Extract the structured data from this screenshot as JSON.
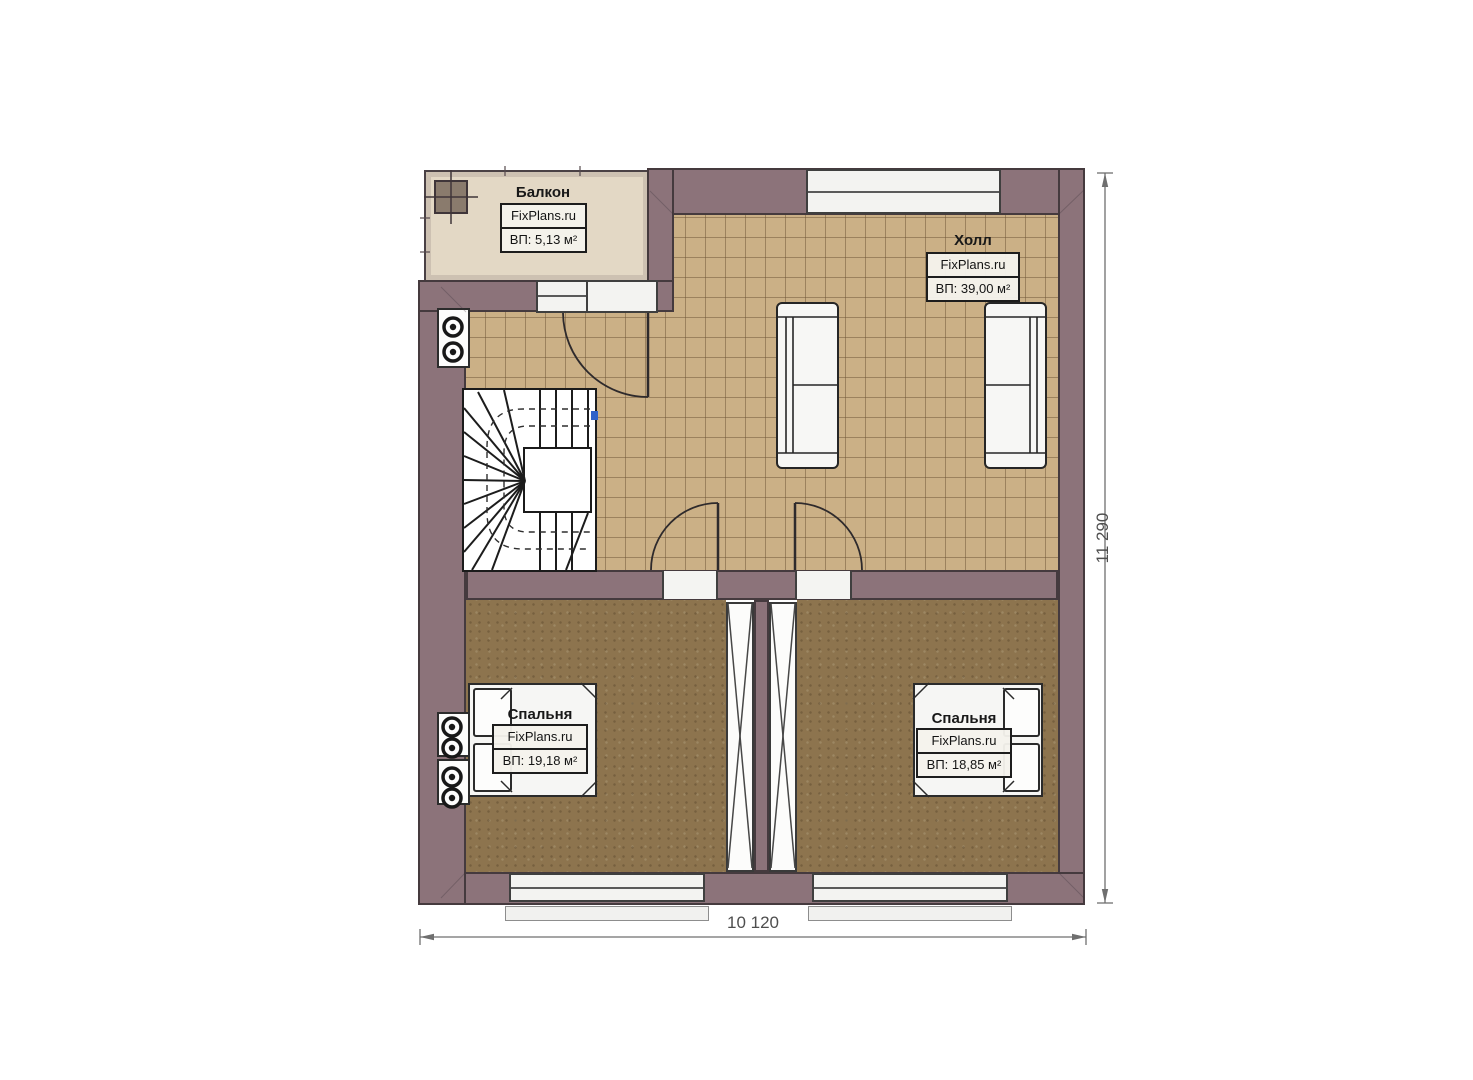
{
  "plan": {
    "rooms": {
      "balcony": {
        "name": "Балкон",
        "source": "FixPlans.ru",
        "area": "ВП: 5,13 м²"
      },
      "hall": {
        "name": "Холл",
        "source": "FixPlans.ru",
        "area": "ВП: 39,00 м²"
      },
      "bedroom_left": {
        "name": "Спальня",
        "source": "FixPlans.ru",
        "area": "ВП: 19,18 м²"
      },
      "bedroom_right": {
        "name": "Спальня",
        "source": "FixPlans.ru",
        "area": "ВП: 18,85 м²"
      }
    },
    "dimensions": {
      "width": "10 120",
      "height": "11 290"
    },
    "colors": {
      "wall": "#8c737a",
      "wall_outline": "#453a3e",
      "hall_floor": "#cbb086",
      "bedroom_floor": "#8d744e",
      "balcony_floor": "#e3d8c5",
      "window": "#f3f3f1",
      "dimension_text": "#4e4e4e",
      "stair_marker": "#2f62c9"
    }
  }
}
